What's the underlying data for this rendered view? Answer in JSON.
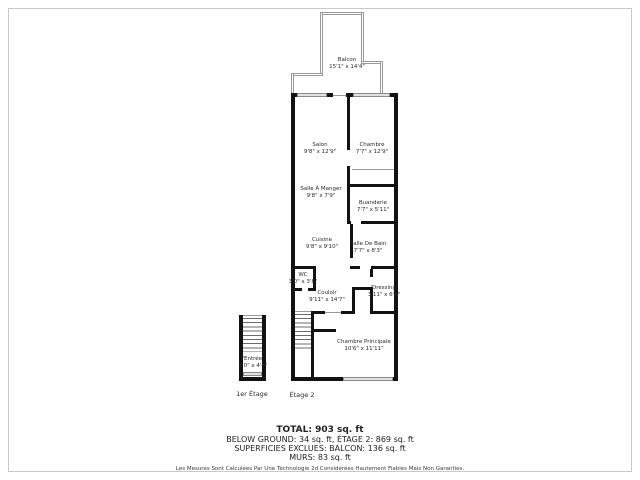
{
  "floorplan": {
    "rooms": [
      {
        "name": "Balcon",
        "dims": "15'1\" x 14'4\""
      },
      {
        "name": "Salon",
        "dims": "9'8\" x 12'9\""
      },
      {
        "name": "Chambre",
        "dims": "7'7\" x 12'9\""
      },
      {
        "name": "Salle À Manger",
        "dims": "9'8\" x 7'9\""
      },
      {
        "name": "Buanderie",
        "dims": "7'7\" x 5'11\""
      },
      {
        "name": "Cuisine",
        "dims": "9'8\" x 9'10\""
      },
      {
        "name": "Salle De Bain",
        "dims": "7'7\" x 8'3\""
      },
      {
        "name": "WC",
        "dims": "3'0\" x 3'8\""
      },
      {
        "name": "Couloir",
        "dims": "9'11\" x 14'7\""
      },
      {
        "name": "'Dressing'",
        "dims": "3'11\" x 6'5\""
      },
      {
        "name": "Chambre Principale",
        "dims": "10'6\" x 11'11\""
      },
      {
        "name": "'Entrée'",
        "dims": "3'0\" x 4'8\""
      }
    ],
    "floor_labels": {
      "first": "1er Étage",
      "second": "Étage 2"
    },
    "summary": {
      "total": "TOTAL: 903 sq. ft",
      "line2": "BELOW GROUND: 34 sq. ft, ÉTAGE 2: 869 sq. ft",
      "line3": "SUPERFICIES EXCLUES: BALCON: 136 sq. ft",
      "line4": "MURS: 83 sq. ft",
      "disclaimer": "Les Mesures Sont Calculées Par Une Technologie 2d Considérées Hautement Fiables Mais Non Garanties."
    },
    "colors": {
      "wall": "#121212",
      "window": "#e2e2e2",
      "railing": "#9a9a9a",
      "text": "#2a2a2a"
    }
  }
}
